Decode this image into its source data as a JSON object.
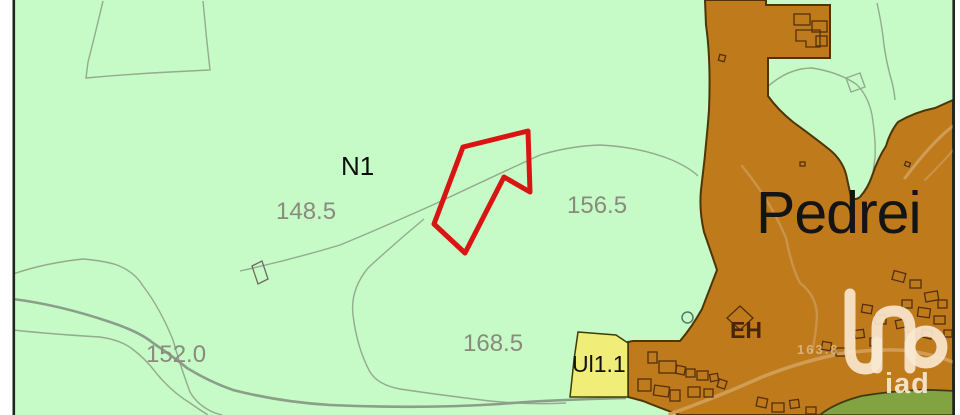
{
  "labels": {
    "n1": {
      "text": "N1"
    },
    "c148": {
      "text": "148.5"
    },
    "c156": {
      "text": "156.5"
    },
    "c168": {
      "text": "168.5"
    },
    "c152": {
      "text": "152.0"
    },
    "eh": {
      "text": "EH"
    },
    "ul11": {
      "text": "Ul1.1"
    },
    "town": {
      "text": "Pedrei"
    },
    "road_elev": {
      "text": "163.8"
    }
  },
  "watermark": {
    "brand": "iad"
  },
  "colors": {
    "rural_green_fill": "#c6fac6",
    "urban_brown_fill": "#bf7a1c",
    "urban_outline": "#4d3506",
    "plot_outline_red": "#d81512",
    "ul_zone_yellow": "#f0ee79",
    "green_zone_fill": "#82a341",
    "contour_line": "#93ab8f",
    "road_gray": "#8a9e8a",
    "road_tan": "#d09d55",
    "contour_label_gray": "#8a8a7e",
    "watermark_cream": "#f8e9cf"
  }
}
